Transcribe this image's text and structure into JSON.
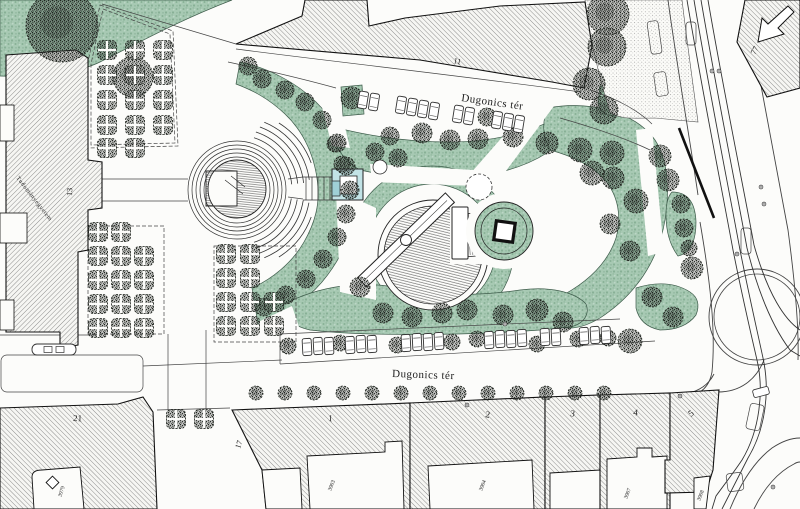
{
  "labels": {
    "street_top": "Dugonics tér",
    "street_bottom": "Dugonics tér",
    "building_11": "11",
    "building_13": "13",
    "building_17": "17",
    "building_21": "21",
    "building_77": "77",
    "building_1": "1",
    "building_2": "2",
    "building_3": "3",
    "building_4": "4",
    "building_5": "5",
    "university": "Tudományegyetem",
    "parcel_3903": "3903",
    "parcel_3904": "3904",
    "parcel_3907": "3907",
    "parcel_3908": "3908",
    "parcel_3979": "3979"
  },
  "colors": {
    "paper": "#fcfcfa",
    "ink": "#222222",
    "park_green": "#a7c9b3",
    "green_stipple": "#87b096",
    "water_cyan": "#c2e3e6",
    "hatch_gray": "#4a4a4a"
  }
}
